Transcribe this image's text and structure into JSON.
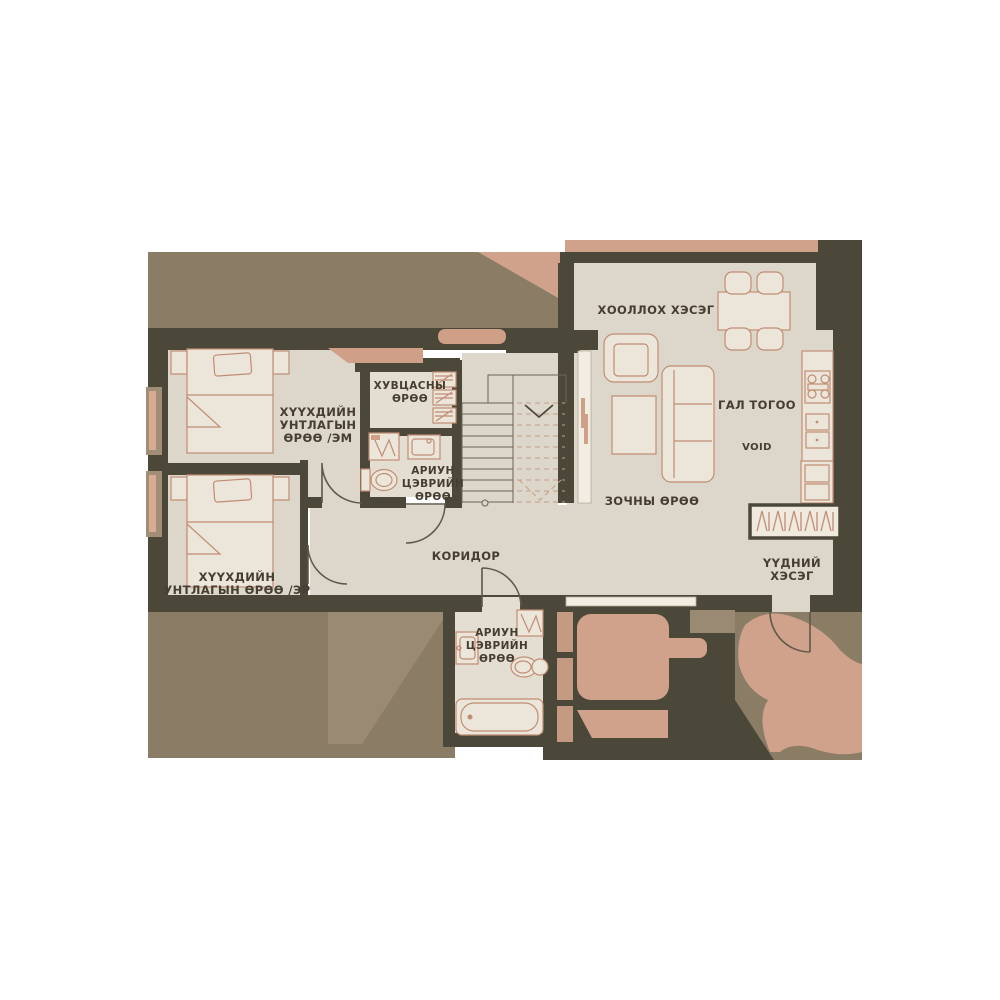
{
  "plan": {
    "rooms": {
      "dining": {
        "label": "ХООЛЛОХ ХЭСЭГ"
      },
      "kitchen": {
        "label": "ГАЛ ТОГОО"
      },
      "void_area": {
        "label": "VOID"
      },
      "living": {
        "label": "ЗОЧНЫ ӨРӨӨ"
      },
      "wardrobe": {
        "line1": "ХУВЦАСНЫ",
        "line2": "ӨРӨӨ"
      },
      "bedroom_em": {
        "line1": "ХҮҮХДИЙН",
        "line2": "УНТЛАГЫН",
        "line3": "ӨРӨӨ /ЭМ"
      },
      "bath_upper": {
        "line1": "АРИУН",
        "line2": "ЦЭВРИЙН",
        "line3": "ӨРӨӨ"
      },
      "bedroom_er": {
        "line1": "ХҮҮХДИЙН",
        "line2": "УНТЛАГЫН ӨРӨӨ /ЭР"
      },
      "corridor": {
        "label": "КОРИДОР"
      },
      "bath_lower": {
        "line1": "АРИУН",
        "line2": "ЦЭВРИЙН",
        "line3": "ӨРӨӨ"
      },
      "entry": {
        "line1": "ҮҮДНИЙ",
        "line2": "ХЭСЭГ"
      }
    },
    "colors": {
      "wall": "#4c4839",
      "floor": "#ddd6ca",
      "exterior": "#8b7c66",
      "accent_salmon": "#d0a28b",
      "furniture_outline": "#c08d74",
      "text": "#463d31"
    }
  }
}
